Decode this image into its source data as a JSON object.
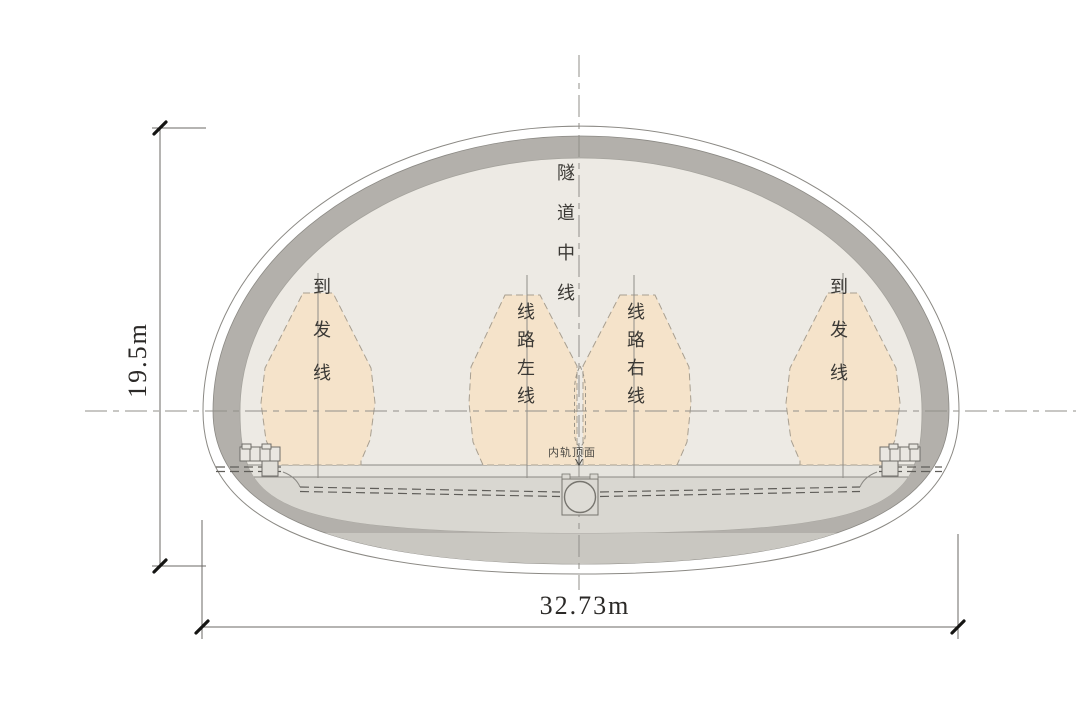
{
  "labels": {
    "tunnel_centerline": "隧道中线",
    "arrival_departure": "到发线",
    "line_left": "线路左线",
    "line_right": "线路右线",
    "inner_rail_top_surface": "内轨顶面"
  },
  "dimensions": {
    "height": "19.5m",
    "width": "32.73m"
  },
  "colors": {
    "lining_ring": "#b3b0ab",
    "invert_band": "#c9c7c1",
    "inner_surface": "#edeae4",
    "track_slab": "#d9d7d1",
    "slab_strip": "#e6e4de",
    "envelope_fill": "#f5e3ca",
    "trough_fill": "#e9e7e1",
    "outline": "#8b8984"
  }
}
